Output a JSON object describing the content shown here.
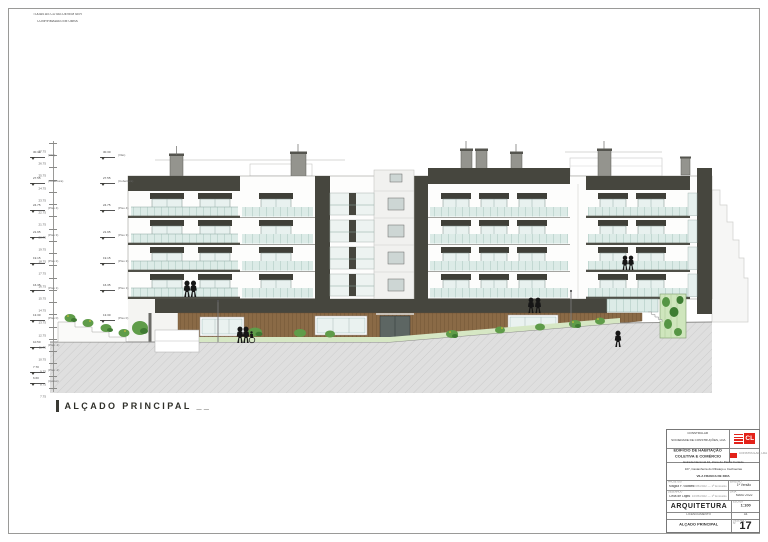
{
  "note": {
    "line1": "TODAS AS COTAS DEVEM SER",
    "line2": "CONFIRMADAS EM OBRA"
  },
  "drawing_title": "ALÇADO PRINCIPAL __",
  "scale_marks": [
    {
      "y": 143,
      "value": "27.75"
    },
    {
      "y": 155,
      "value": "26.75"
    },
    {
      "y": 167,
      "value": "25.75"
    },
    {
      "y": 180,
      "value": "24.75"
    },
    {
      "y": 192,
      "value": "23.75"
    },
    {
      "y": 204,
      "value": "22.75"
    },
    {
      "y": 216,
      "value": "21.75"
    },
    {
      "y": 229,
      "value": "20.75"
    },
    {
      "y": 241,
      "value": "19.75"
    },
    {
      "y": 253,
      "value": "18.75"
    },
    {
      "y": 265,
      "value": "17.75"
    },
    {
      "y": 278,
      "value": "16.75"
    },
    {
      "y": 290,
      "value": "15.75"
    },
    {
      "y": 302,
      "value": "14.75"
    },
    {
      "y": 314,
      "value": "13.75"
    },
    {
      "y": 327,
      "value": "12.75"
    },
    {
      "y": 339,
      "value": "11.75"
    },
    {
      "y": 351,
      "value": "10.75"
    },
    {
      "y": 363,
      "value": "9.75"
    },
    {
      "y": 376,
      "value": "8.75"
    },
    {
      "y": 388,
      "value": "7.75"
    }
  ],
  "levels_left": [
    {
      "y": 157,
      "value": "30.30",
      "label": "(Vão)"
    },
    {
      "y": 183,
      "value": "27.55",
      "label": "(Cobertura)"
    },
    {
      "y": 210,
      "value": "24.75",
      "label": "(Piso 4)"
    },
    {
      "y": 237,
      "value": "21.95",
      "label": "(Piso 3)"
    },
    {
      "y": 263,
      "value": "19.15",
      "label": "(Piso 2)"
    },
    {
      "y": 290,
      "value": "16.35",
      "label": "(Piso 1)"
    },
    {
      "y": 320,
      "value": "13.30",
      "label": "(Piso 0)"
    },
    {
      "y": 347,
      "value": "10.50",
      "label": "(Piso -1)"
    },
    {
      "y": 372,
      "value": "7.70",
      "label": "(Piso -2)"
    },
    {
      "y": 383,
      "value": "6.60",
      "label": "(Caves)"
    }
  ],
  "levels_inner": [
    {
      "y": 157,
      "value": "30.30",
      "label": "(Vão)"
    },
    {
      "y": 183,
      "value": "27.55",
      "label": "(Cobertura)"
    },
    {
      "y": 210,
      "value": "24.75",
      "label": "(Piso 4)"
    },
    {
      "y": 237,
      "value": "21.95",
      "label": "(Piso 3)"
    },
    {
      "y": 263,
      "value": "19.15",
      "label": "(Piso 2)"
    },
    {
      "y": 290,
      "value": "16.35",
      "label": "(Piso 1)"
    },
    {
      "y": 320,
      "value": "13.30",
      "label": "(Piso 0)"
    }
  ],
  "title_block": {
    "company_line1": "CONSTRULAR",
    "company_line2": "SOCIEDADE DE CONSTRUÇÕES, LDA",
    "logo_text": "CL",
    "logo_sub": "CONSTRULAR, LDA",
    "project_line1": "EDIFÍCIO DE HABITAÇÃO",
    "project_line2": "COLETIVA E COMÉRCIO",
    "address_line1": "Estrada Nacional 10, Zona do Pastor Furtado",
    "address_line2": "107, Castanheira do Ribatejo e Cachoeiras",
    "address_line3": "VILA FRANCA DE XIRA",
    "field1_label": "PROJETOU",
    "field1_value": "Magda F. Gomes",
    "field1_note": "Data: 10/05/2022 — 1ª Emissão",
    "field2_label": "DESENHOU",
    "field2_value": "Célia de Lajes",
    "field2_note": "Data: 10/05/2022 — 1ª Emissão",
    "rev_label": "EMISSÃO",
    "rev_value": "1ª Versão",
    "date_label": "DATA",
    "date_value": "MAIO 2022",
    "specialty": "ARQUITETURA",
    "scale_label": "ESCALA",
    "scale_value": "1:100",
    "phase": "LICENCIAMENTO",
    "format_label": "FORMATO",
    "format_value": "A1",
    "sheet_title": "ALÇADO PRINCIPAL",
    "sheet_label": "DESENHO Nº",
    "sheet_number": "17"
  },
  "colors": {
    "accent_red": "#e32219",
    "facade_dark": "#46463e",
    "window_glass": "#e8f1ef",
    "balcony_glass": "#dcebe7",
    "wood": "#8a6a46",
    "greenery": "#5f9c49",
    "ground_hatch": "#dedede"
  }
}
